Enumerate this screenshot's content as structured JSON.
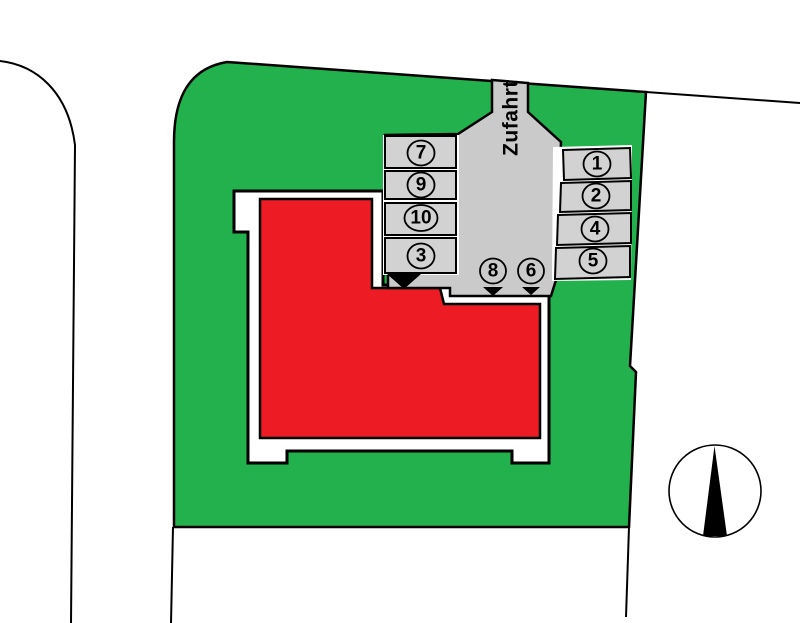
{
  "plan": {
    "type": "site-plan",
    "driveway_label": "Zufahrt",
    "parking": {
      "left_column": [
        {
          "label": "7"
        },
        {
          "label": "9"
        },
        {
          "label": "10"
        },
        {
          "label": "3"
        }
      ],
      "right_column": [
        {
          "label": "1"
        },
        {
          "label": "2"
        },
        {
          "label": "4"
        },
        {
          "label": "5"
        }
      ],
      "court_markers": [
        {
          "label": "8"
        },
        {
          "label": "6"
        }
      ]
    },
    "colors": {
      "grass": "#22b14c",
      "building": "#ed1c24",
      "pavement": "#cacaca",
      "stall": "#d2d2d2",
      "plot": "#ffffff",
      "outline": "#000000"
    }
  }
}
